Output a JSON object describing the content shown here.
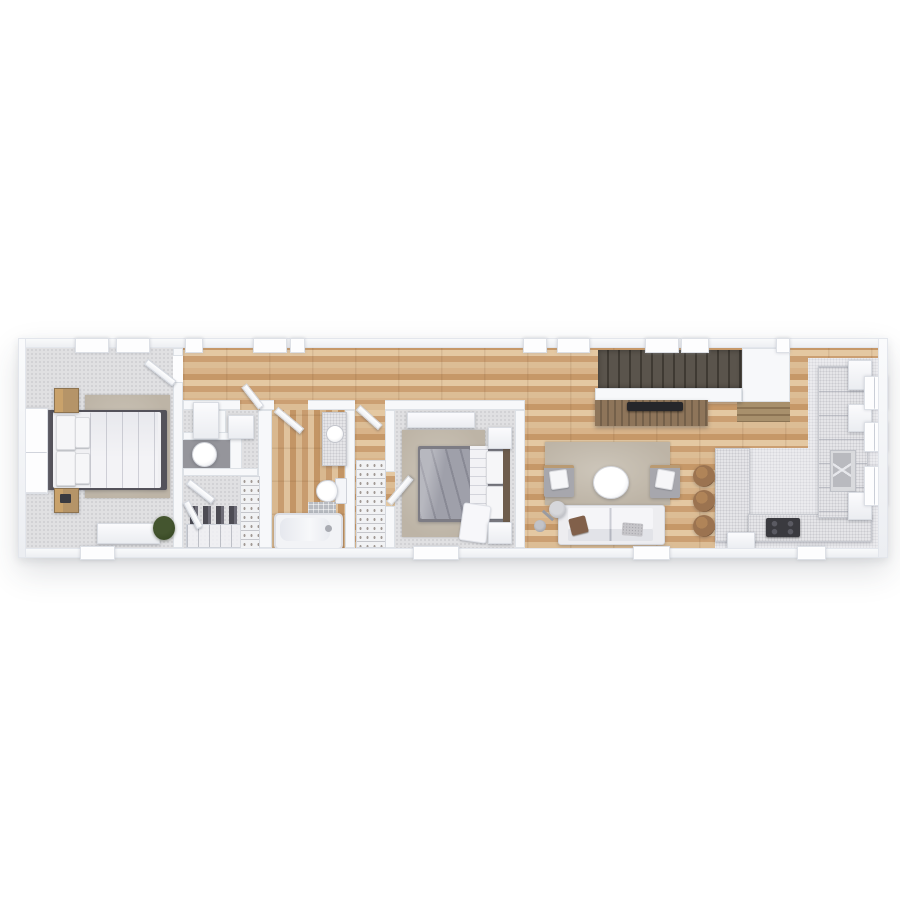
{
  "scene": {
    "type": "3d-floor-plan-top-down-render",
    "background": "#ffffff",
    "rooms": [
      {
        "name": "bedroom-primary",
        "floor": "carpet",
        "furniture": [
          "double-bed",
          "pillows",
          "nightstand-top",
          "nightstand-bottom",
          "book",
          "area-rug",
          "dresser",
          "potted-plant",
          "side-window",
          "top-windows",
          "bottom-window",
          "entry-door"
        ]
      },
      {
        "name": "hallway",
        "floor": "wood-plank",
        "furniture": [
          "open-doors"
        ]
      },
      {
        "name": "utility-nook",
        "floor": "carpet",
        "furniture": [
          "cabinet",
          "cabinet",
          "round-table-alcove"
        ]
      },
      {
        "name": "walk-in-closet",
        "floor": "carpet",
        "furniture": [
          "double-doors",
          "hanging-clothes",
          "shoe-rack",
          "shoe-shelf-column"
        ]
      },
      {
        "name": "bathroom",
        "floor": "wood-plank",
        "furniture": [
          "vanity-counter",
          "round-sink",
          "toilet",
          "bath-mat",
          "bathtub",
          "tub-faucet",
          "door"
        ]
      },
      {
        "name": "linen-closet",
        "floor": "wood-plank",
        "furniture": [
          "shelf-unit",
          "door"
        ]
      },
      {
        "name": "bedroom-second",
        "floor": "carpet",
        "furniture": [
          "double-bed-gray-duvet",
          "white-throw",
          "nightstand-top",
          "nightstand-bottom",
          "long-dresser",
          "area-rug",
          "door",
          "bottom-window"
        ]
      },
      {
        "name": "living-room",
        "floor": "wood-plank",
        "furniture": [
          "area-rug",
          "armchair-left",
          "armchair-right",
          "round-coffee-table",
          "sofa",
          "throw-pillow-brown",
          "throw-pillow-gray",
          "floor-lamp",
          "tv-console",
          "tv",
          "bottom-window"
        ]
      },
      {
        "name": "staircase",
        "furniture": [
          "upper-flight-dark-treads",
          "lower-steps-wood",
          "landing-wall"
        ]
      },
      {
        "name": "kitchen",
        "floor": "wood-and-tile",
        "furniture": [
          "peninsula-counter",
          "bar-stool",
          "bar-stool",
          "bar-stool",
          "bottom-counter",
          "cooktop",
          "right-counter",
          "sink",
          "wall-cabinet",
          "wall-cabinet",
          "wall-cabinet",
          "window",
          "window",
          "window",
          "base-cabinet",
          "bottom-window"
        ]
      }
    ]
  },
  "colors": {
    "wall": "#f7f8fa",
    "wallHi": "#fafbfc",
    "wallLo": "#eceef2",
    "wood": "#d2ab7e",
    "carpet": "#e0e0e2",
    "tile": "#ebebee",
    "rug": "#bdb4a6",
    "rugHi": "#cdc6ba",
    "counter": "#e5e5e8",
    "counterEdge": "#c7c9cf",
    "stair": "#5a544c",
    "stairLine": "#3f3a33",
    "console": "#8e755a",
    "consoleLine": "#74604a",
    "tv": "#26262a",
    "cooktop": "#3a3a3f",
    "sink": "#b9babf",
    "bedFrame": "#54525a",
    "headboard2": "#6e5d4d",
    "duvetGray": "#9fa0aa",
    "nightstandTan": "#b59468",
    "nightstandGold": "#c9a26b",
    "sofa": "#ededf0",
    "chair": "#a7a7ad",
    "pillowBrown": "#81604a",
    "pillowGray": "#c6c5c9",
    "stool": "#9b7350",
    "stoolDark": "#7a5a3e",
    "plant": "#44552f",
    "plantDark": "#32431f",
    "niche": "#95959b",
    "white": "#ffffff"
  }
}
